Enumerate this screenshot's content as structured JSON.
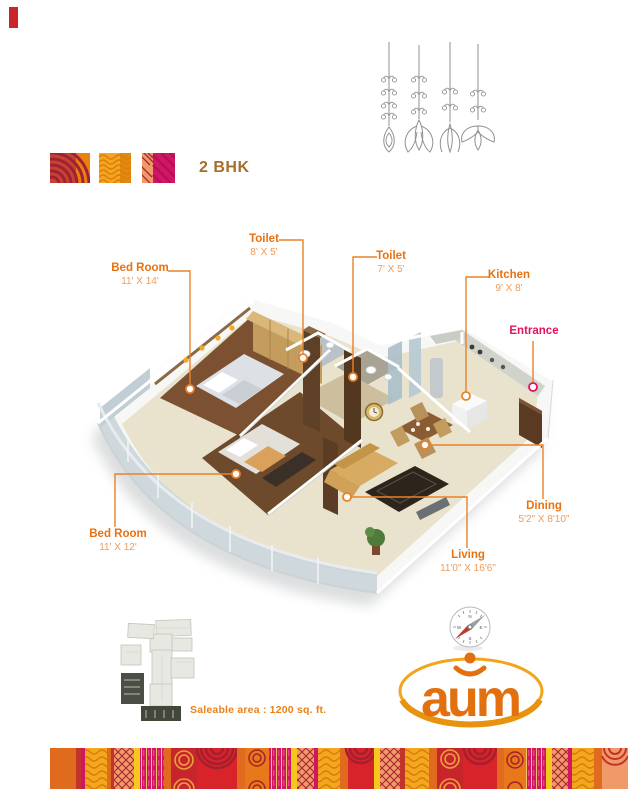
{
  "header": {
    "title": "2 BHK",
    "swatch_colors": [
      "#c8432f",
      "#f0a818",
      "#d31566"
    ]
  },
  "plan_labels": {
    "bedroom1": {
      "name": "Bed Room",
      "dims": "11' X 14'"
    },
    "toilet1": {
      "name": "Toilet",
      "dims": "8' X 5'"
    },
    "toilet2": {
      "name": "Toilet",
      "dims": "7' X 5'"
    },
    "kitchen": {
      "name": "Kitchen",
      "dims": "9' X 8'"
    },
    "entrance": {
      "name": "Entrance"
    },
    "dining": {
      "name": "Dining",
      "dims": "5'2\" X 8'10\""
    },
    "living": {
      "name": "Living",
      "dims": "11'0\" X 16'6\""
    },
    "bedroom2": {
      "name": "Bed Room",
      "dims": "11' X 12'"
    }
  },
  "footer": {
    "saleable_area": "Saleable area : 1200 sq. ft."
  },
  "brand": {
    "logo_text": "aum",
    "logo_color": "#e2700f",
    "swoosh_color": "#f2a41a"
  },
  "compass": {
    "north": "N",
    "east": "E",
    "south": "S",
    "west": "W"
  },
  "colors": {
    "label_orange": "#e87211",
    "label_dim_orange": "#f09a55",
    "entrance_pink": "#e31260",
    "title_brown": "#a66d2b",
    "leader_line": "#e8822a"
  }
}
